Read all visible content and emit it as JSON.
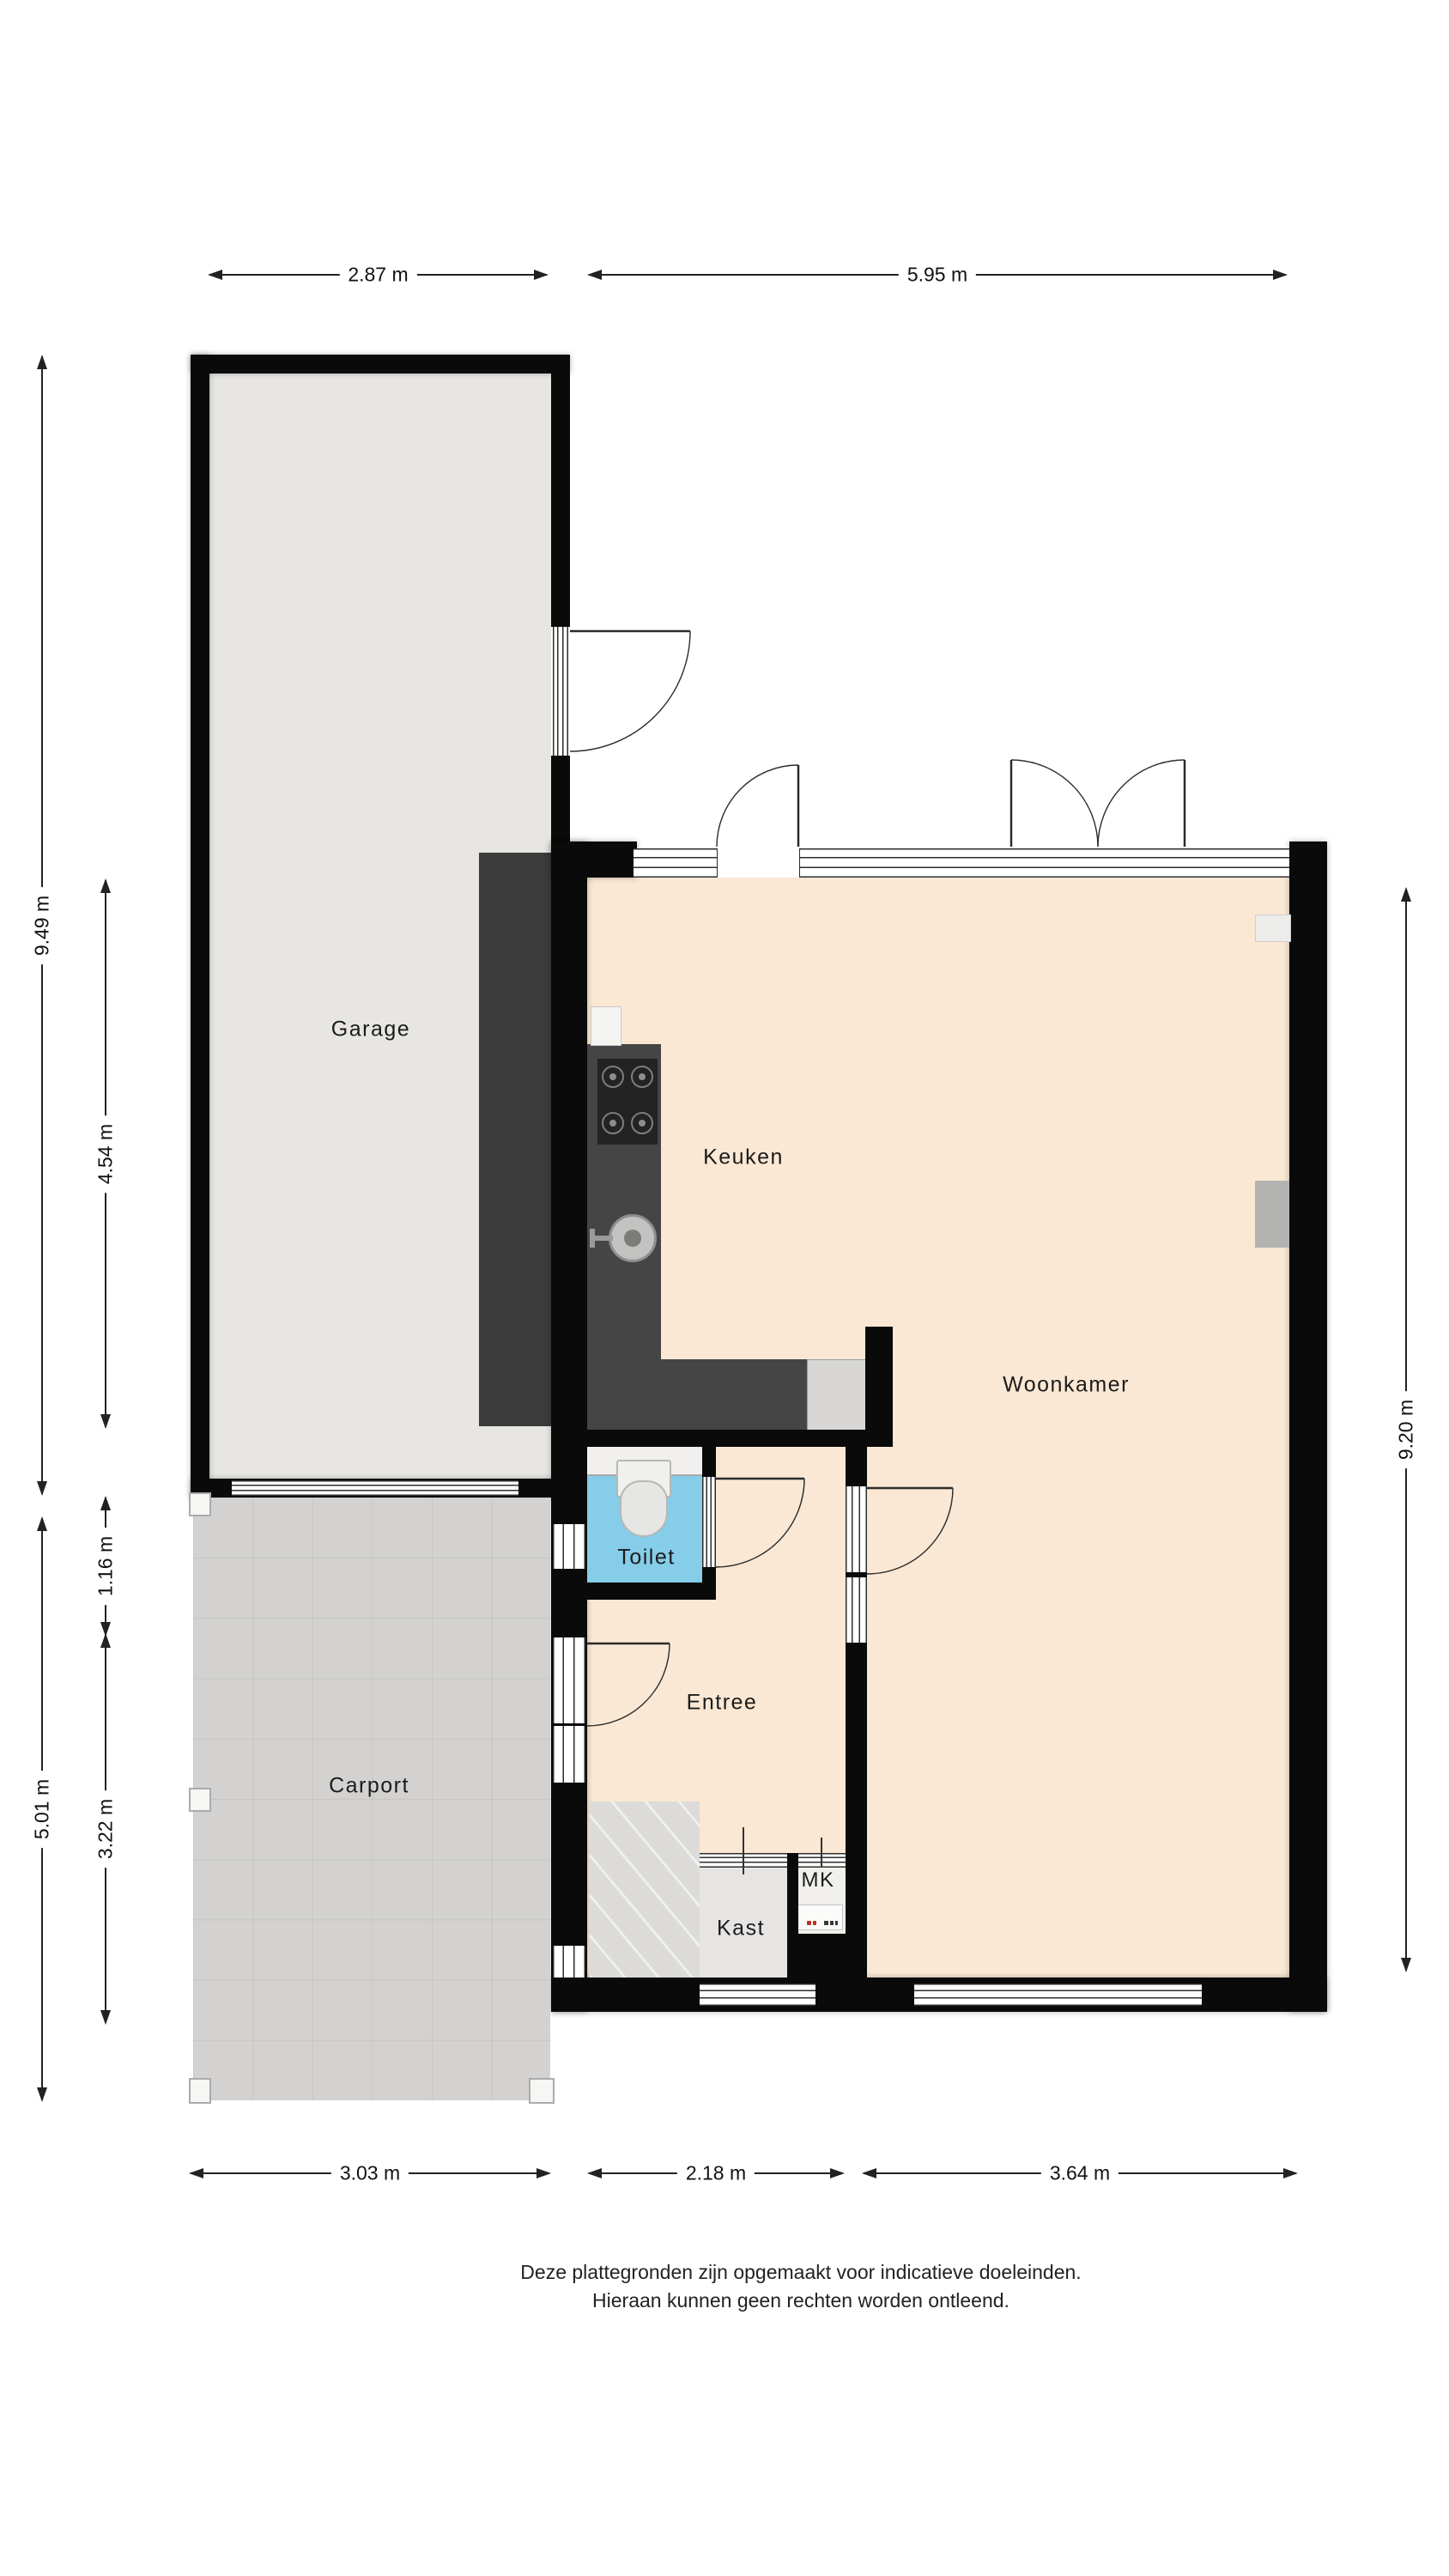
{
  "rooms": {
    "garage": {
      "label": "Garage"
    },
    "keuken": {
      "label": "Keuken"
    },
    "woonkamer": {
      "label": "Woonkamer"
    },
    "toilet": {
      "label": "Toilet"
    },
    "entree": {
      "label": "Entree"
    },
    "carport": {
      "label": "Carport"
    },
    "kast": {
      "label": "Kast"
    },
    "mk": {
      "label": "MK"
    }
  },
  "dimensions": {
    "top": [
      {
        "label": "2.87 m"
      },
      {
        "label": "5.95 m"
      }
    ],
    "bottom": [
      {
        "label": "3.03 m"
      },
      {
        "label": "2.18 m"
      },
      {
        "label": "3.64 m"
      }
    ],
    "left": [
      {
        "label": "9.49 m"
      },
      {
        "label": "4.54 m"
      },
      {
        "label": "1.16 m"
      },
      {
        "label": "3.22 m"
      },
      {
        "label": "5.01 m"
      }
    ],
    "right": [
      {
        "label": "9.20 m"
      }
    ]
  },
  "footer": {
    "line1": "Deze plattegronden zijn opgemaakt voor indicatieve doeleinden.",
    "line2": "Hieraan kunnen geen rechten worden ontleend."
  },
  "colors": {
    "wall": "#0a0a0a",
    "floor_living": "#fae8d4",
    "floor_garage": "#e8e6e2",
    "floor_toilet": "#85cde9",
    "floor_carport": "#d3d2d0",
    "floor_kast": "#e6e5e3",
    "counter": "#454545",
    "dimension_line": "#222222"
  }
}
